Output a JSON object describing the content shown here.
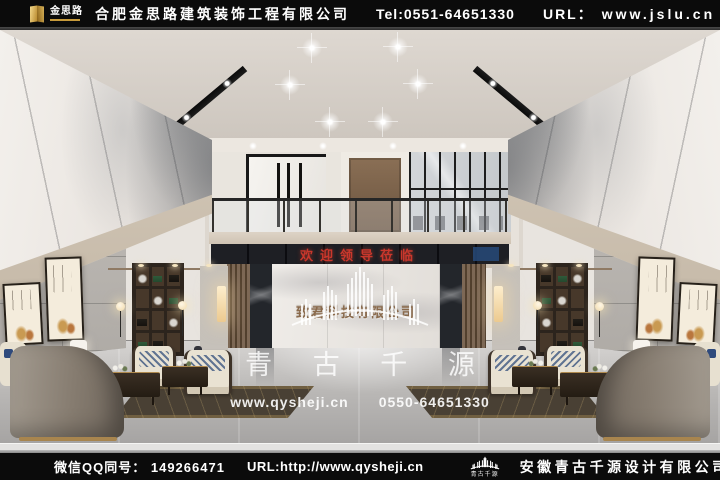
{
  "window": {
    "width": 720,
    "height": 480
  },
  "header": {
    "logo_text": "金思路",
    "company_name": "合肥金思路建筑装饰工程有限公司",
    "tel": "Tel:0551-64651330",
    "url_label": "URL：",
    "url_value": "www.jslu.cn"
  },
  "footer": {
    "wechat_qq_label": "微信QQ同号：",
    "qq_number": "149266471",
    "url": "URL:http://www.qysheji.cn",
    "logo_caption": "青古千源",
    "company_name": "安徽青古千源设计有限公司"
  },
  "scene": {
    "led_banner_text": "欢迎领导莅临",
    "reception_wall_text": "致君科技有限公司",
    "watermark": {
      "brand": "青 古 千 源",
      "website": "www.qysheji.cn",
      "phone": "0550-64651330"
    }
  },
  "colors": {
    "bar_background": "#0b0b0b",
    "led_text_red": "#c9372c",
    "bronze_signage": "#8a6a4c",
    "logo_gold": "#c79a3b",
    "watermark_white": "rgba(255,255,255,0.82)"
  }
}
